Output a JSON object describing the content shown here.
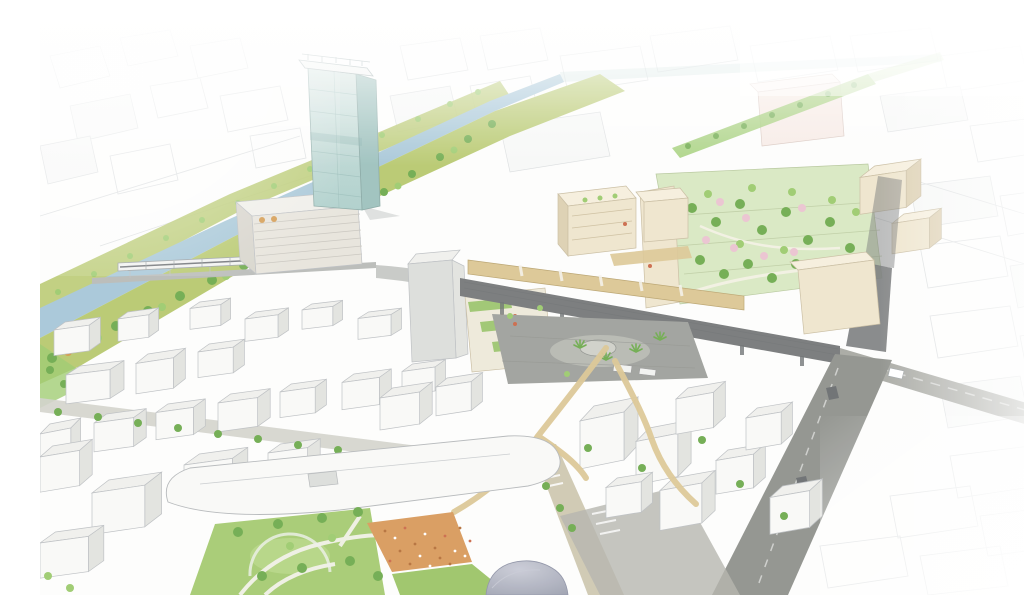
{
  "scene": {
    "type": "architectural-aerial-perspective-sketch",
    "subject": "Hand-drawn bird's-eye masterplan illustration of a station-area urban redevelopment with a landmark glass tower, river corridor, rail viaduct, rooftop parks and plazas",
    "elements": [
      "faded-sketch-cityscape",
      "river",
      "green-embankments",
      "rail-bridge-with-train",
      "glass-tower",
      "striped-podium-building",
      "station-viaduct",
      "pedestrian-deck",
      "station-plaza",
      "terraced-roof-park-with-blossoms",
      "linear-sky-park",
      "white-building-field",
      "tree-lined-avenue",
      "curved-roof-mall",
      "lawn-park-with-paths",
      "orange-event-plaza-with-crowd",
      "dome-roof",
      "south-road",
      "east-road"
    ]
  },
  "colors": {
    "background": "#fdfdfc",
    "white": "#ffffff",
    "sketch_line": "#d7dadc",
    "sketch_fill": "#f7f8f7",
    "building_white": "#f9f9f7",
    "building_top": "#f0f0ed",
    "building_side": "#e2e3df",
    "building_outline": "#bcbfc2",
    "cream_front": "#efe5cd",
    "cream_top": "#f6efdd",
    "cream_side": "#ddd0b2",
    "cream_outline": "#c9bda1",
    "pink_cream": "#f7ebe5",
    "tower_glass_light": "#d3e4e0",
    "tower_glass": "#aecfcb",
    "tower_glass_side": "#9dc1bd",
    "tower_line": "#8fb5b1",
    "river": "#a7c7d8",
    "grass_bank": "#b8c96f",
    "tree_green": "#6fab4e",
    "tree_light": "#9ccb6e",
    "tree_orange": "#d39a4e",
    "blossom_pink": "#eac3d0",
    "park_base": "#d9e8c2",
    "park_line": "#b6c79c",
    "lawn": "#a6cb72",
    "lawn_light": "#bcd98c",
    "green_roof": "#8fbf5d",
    "deck_tan": "#dcc794",
    "deck_edge": "#b9a36e",
    "viaduct": "#77797a",
    "viaduct_dark": "#6d7072",
    "plaza_gray": "#9fa19c",
    "plaza_gray_light": "#b7b9b2",
    "road_dark": "#90928d",
    "road_mid": "#a8a9a3",
    "road_light": "#d2d2ca",
    "road_tan": "#cfc9b2",
    "plaza_orange": "#d89a5c",
    "plaza_orange_dark": "#b5703a",
    "dome": "#9b9fae",
    "dome_light": "#c9cbd6",
    "rail_gray": "#b9bbb8",
    "train_white": "#f2f3f1",
    "accent_red": "#cb6a4a"
  }
}
